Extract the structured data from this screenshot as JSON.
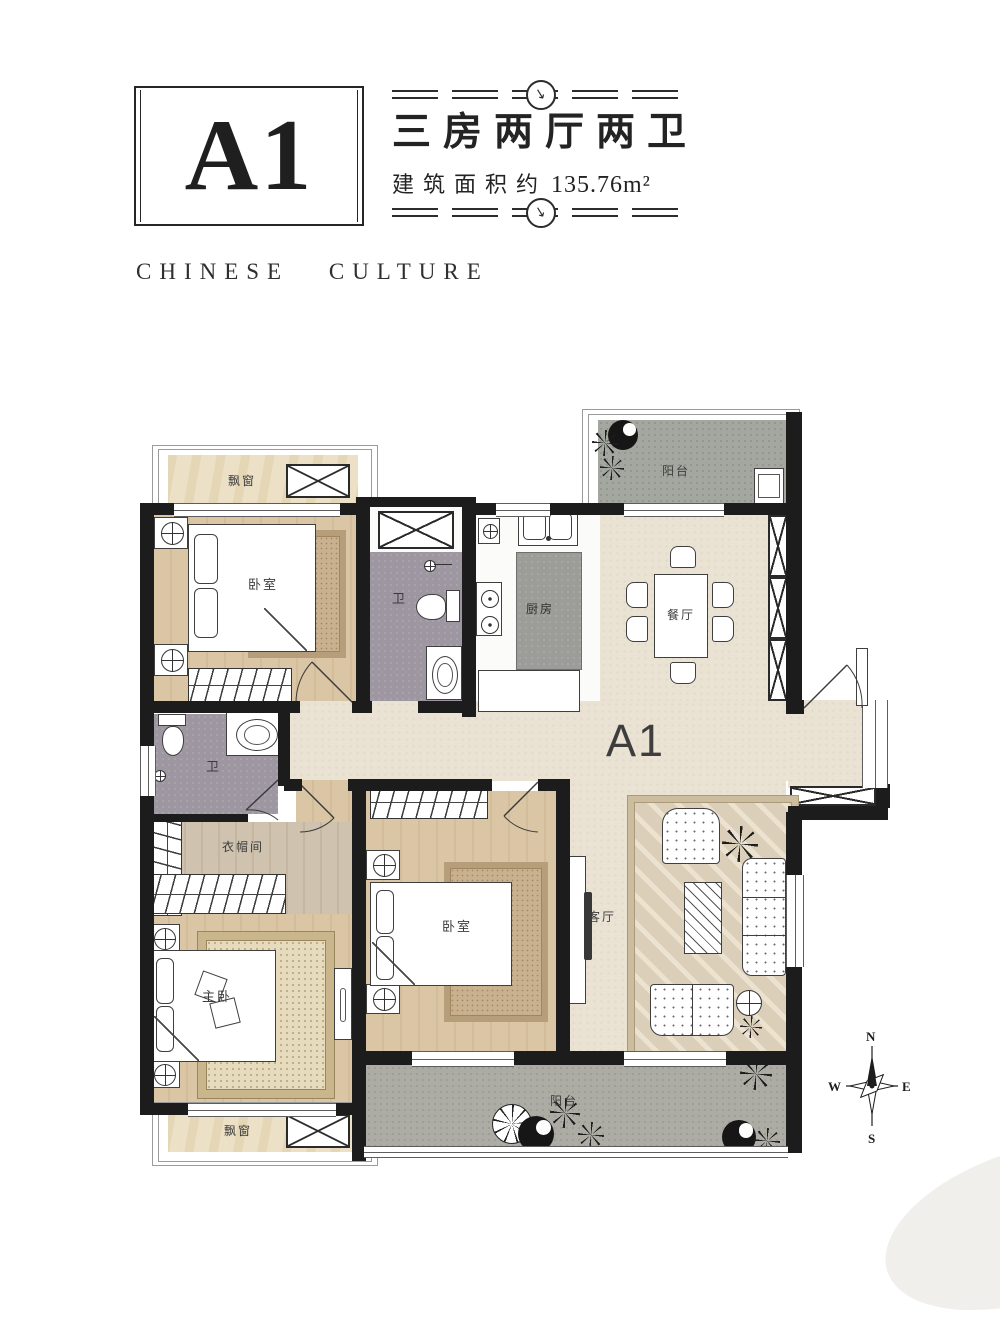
{
  "header": {
    "unit_code": "A1",
    "layout_title": "三房两厅两卫",
    "area_label": "建筑面积约",
    "area_value": "135.76m²",
    "tagline": "CHINESE CULTURE",
    "divider_arrow": "↓"
  },
  "plan": {
    "unit_label": "A1",
    "rooms": {
      "bay_window_top": "飘窗",
      "bedroom_top": "卧室",
      "bath_top": "卫",
      "kitchen": "厨房",
      "dining": "餐厅",
      "balcony_top": "阳台",
      "bath_left": "卫",
      "cloakroom": "衣帽间",
      "master_bedroom": "主卧",
      "bedroom_middle": "卧室",
      "living_room": "客厅",
      "balcony_bottom": "阳台",
      "bay_window_bottom": "飘窗"
    },
    "compass": {
      "north": "N",
      "east": "E",
      "south": "S",
      "west": "W"
    }
  },
  "colors": {
    "wall": "#1c1c1c",
    "wood_floor": "#d7c2a2",
    "cream_floor": "#eae2d3",
    "bath_floor": "#9e97a1",
    "balcony_floor": "#a4a79f",
    "bay_floor": "#ece1c6",
    "counter": "#9c9c98",
    "text": "#232323"
  }
}
